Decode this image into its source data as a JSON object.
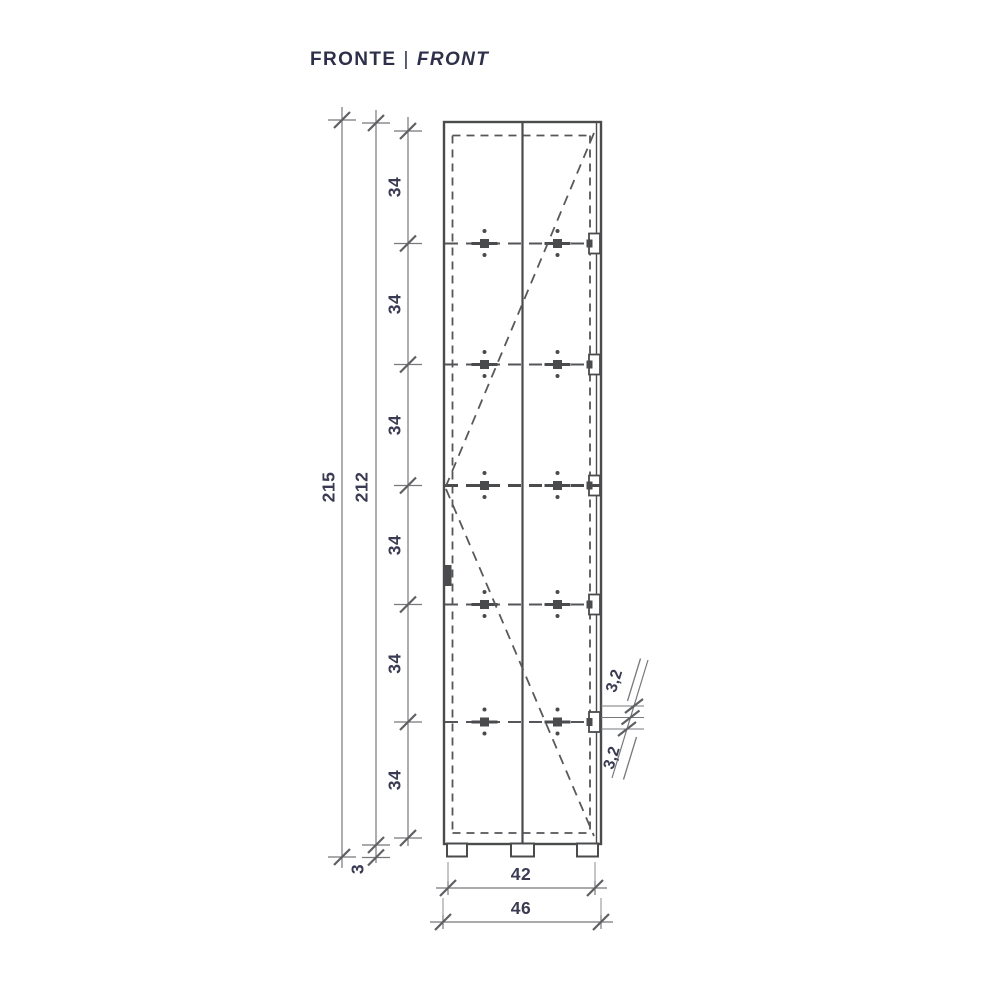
{
  "title": {
    "label_it": "FRONTE",
    "separator": "|",
    "label_en": "FRONT"
  },
  "drawing": {
    "view": "front elevation technical drawing",
    "subject": "tall two-door column cabinet with five shelf lines, door-swing dashed diagonals and three feet"
  },
  "dimensions": {
    "total_height": "215",
    "body_height": "212",
    "base_height": "3",
    "shelf_spacings": [
      "34",
      "34",
      "34",
      "34",
      "34",
      "34"
    ],
    "inner_width": "42",
    "outer_width": "46",
    "thickness_top": "3,2",
    "thickness_bottom": "3,2"
  },
  "colors": {
    "background": "#ffffff",
    "cabinet_line": "#4a4b4d",
    "hidden_line": "#55565a",
    "dimension_line": "#77787c",
    "tick_mark": "#5f6063",
    "dimension_text": "#3a3b52",
    "title_text": "#2e3049"
  }
}
